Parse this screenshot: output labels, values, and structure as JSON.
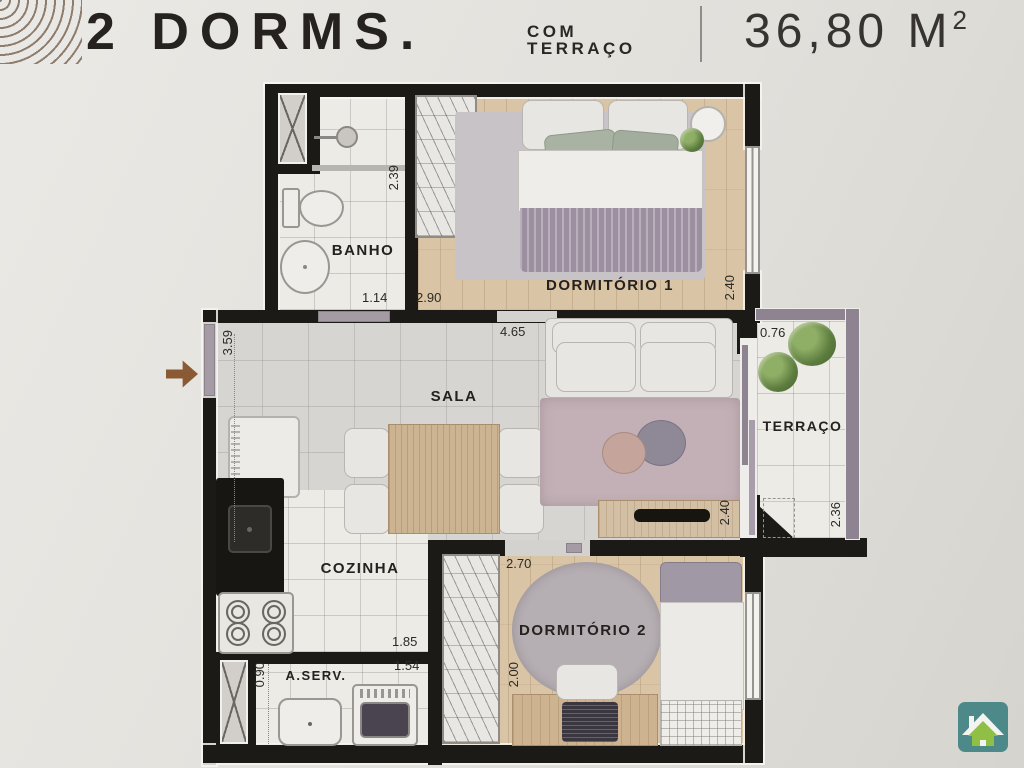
{
  "header": {
    "title": "2 DORMS.",
    "subtitle": [
      "COM",
      "TERRAÇO"
    ],
    "area_value": "36,80 M",
    "area_sup": "2"
  },
  "rooms": {
    "banho": {
      "label": "BANHO"
    },
    "dorm1": {
      "label": "DORMITÓRIO 1"
    },
    "sala": {
      "label": "SALA"
    },
    "terraco": {
      "label": "TERRAÇO"
    },
    "cozinha": {
      "label": "COZINHA"
    },
    "aserv": {
      "label": "A.SERV."
    },
    "dorm2": {
      "label": "DORMITÓRIO 2"
    }
  },
  "dims": {
    "banho_w": "1.14",
    "banho_h": "2.39",
    "dorm1_w": "2.90",
    "dorm1_h": "2.40",
    "sala_w": "4.65",
    "sala_h": "3.59",
    "terraco_w": "0.76",
    "terraco_h": "2.36",
    "sala_right_h": "2.40",
    "cozinha_w": "1.85",
    "aserv_w": "1.54",
    "aserv_h": "0.90",
    "dorm2_w": "2.70",
    "dorm2_h": "2.00"
  },
  "icons": {
    "brand_arcs": "concentric-arcs-logo",
    "entrance": "entrance-arrow",
    "watermark": "green-house-logo"
  },
  "colors": {
    "wall": "#1c1a17",
    "terrace_wall": "#8e8390",
    "arrow_brown": "#8a5a35",
    "logo_teal": "#4e898a",
    "logo_green": "#8fc045",
    "background": "#e2e0db"
  }
}
